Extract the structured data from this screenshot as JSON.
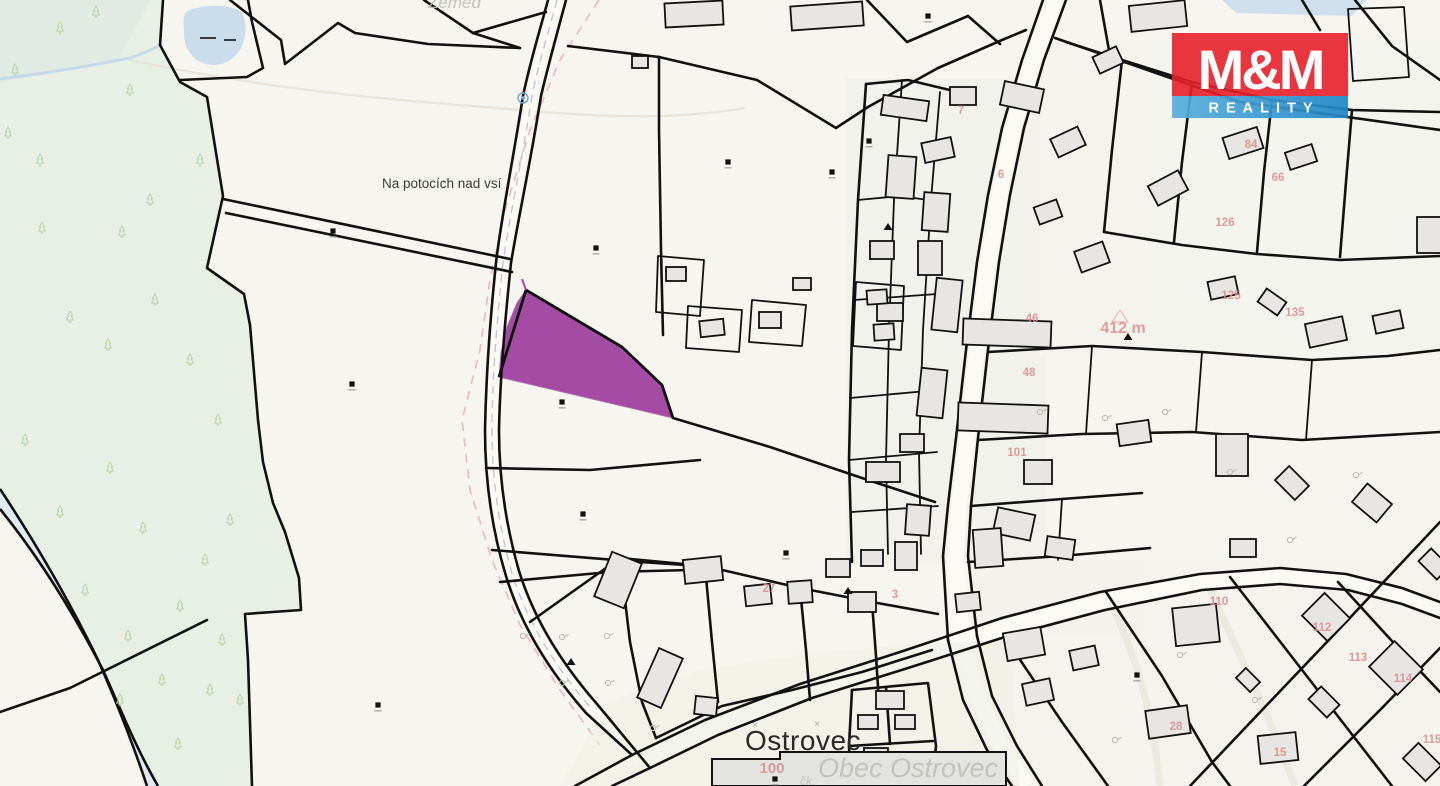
{
  "logo": {
    "line1": "M&M",
    "line2": "REALITY",
    "red": "#e7202a",
    "blue": "#2e96d5",
    "text_color": "#ffffff"
  },
  "map": {
    "labels": {
      "field_name": "Na potocích nad vsí",
      "village_name": "Ostrovec",
      "municipality": "Obec Ostrovec",
      "municipality_fragment": "čk.",
      "top_edge_fragment": "Zeměd",
      "elevation": "412 m",
      "parcel_number_large": "100"
    },
    "colors": {
      "background": "#f7f5ef",
      "forest": "#e8efe4",
      "water": "#cadded",
      "building": "#e7e6e4",
      "boundary": "#111111",
      "highlight": "#a44ba4",
      "house_number": "#d98b8b",
      "road_fill": "#fbfaf5"
    },
    "house_numbers": [
      {
        "t": "46",
        "x": 1032,
        "y": 322
      },
      {
        "t": "48",
        "x": 1029,
        "y": 376
      },
      {
        "t": "101",
        "x": 1017,
        "y": 456
      },
      {
        "t": "7",
        "x": 961,
        "y": 114
      },
      {
        "t": "6",
        "x": 1001,
        "y": 178
      },
      {
        "t": "126",
        "x": 1225,
        "y": 226
      },
      {
        "t": "125",
        "x": 1231,
        "y": 299
      },
      {
        "t": "135",
        "x": 1295,
        "y": 316
      },
      {
        "t": "66",
        "x": 1278,
        "y": 181
      },
      {
        "t": "84",
        "x": 1251,
        "y": 148
      },
      {
        "t": "110",
        "x": 1219,
        "y": 605
      },
      {
        "t": "112",
        "x": 1322,
        "y": 631
      },
      {
        "t": "113",
        "x": 1358,
        "y": 661
      },
      {
        "t": "114",
        "x": 1403,
        "y": 682
      },
      {
        "t": "115",
        "x": 1432,
        "y": 743
      },
      {
        "t": "15",
        "x": 1280,
        "y": 756
      },
      {
        "t": "28",
        "x": 1176,
        "y": 730
      },
      {
        "t": "27",
        "x": 769,
        "y": 592
      },
      {
        "t": "3",
        "x": 895,
        "y": 598
      },
      {
        "t": "100",
        "x": 772,
        "y": 773,
        "s": 15
      }
    ]
  }
}
